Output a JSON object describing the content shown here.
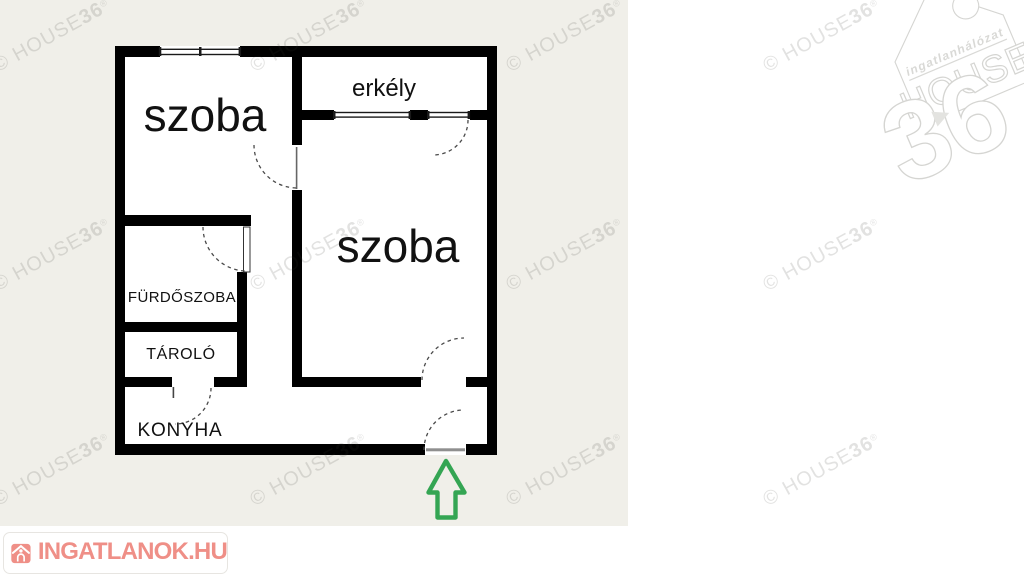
{
  "plan": {
    "labels": {
      "szoba1": "szoba",
      "erkely": "erkély",
      "szoba2": "szoba",
      "furdoszoba": "FÜRDŐSZOBA",
      "tarolo": "TÁROLÓ",
      "konyha": "KONYHA"
    }
  },
  "watermark": {
    "prefix": "© HOUSE",
    "bold": "36",
    "registered": "®",
    "positions": [
      {
        "x": 52,
        "y": 36
      },
      {
        "x": 309,
        "y": 36
      },
      {
        "x": 565,
        "y": 36
      },
      {
        "x": 822,
        "y": 36
      },
      {
        "x": 52,
        "y": 255
      },
      {
        "x": 309,
        "y": 255
      },
      {
        "x": 565,
        "y": 255
      },
      {
        "x": 822,
        "y": 255
      },
      {
        "x": 52,
        "y": 470
      },
      {
        "x": 309,
        "y": 470
      },
      {
        "x": 565,
        "y": 470
      },
      {
        "x": 822,
        "y": 470
      }
    ]
  },
  "logo_house36": {
    "network": "ingatlanhálózat",
    "name": "HOUSE",
    "number": "36"
  },
  "logo_ingatlanok": {
    "text": "INGATLANOK.HU"
  },
  "colors": {
    "plan-beige": "#f0efe9",
    "wall-black": "#000000",
    "arrow-green": "#34a553",
    "ing-coral": "#ef8f87",
    "wm-color": "#3a3a35"
  }
}
